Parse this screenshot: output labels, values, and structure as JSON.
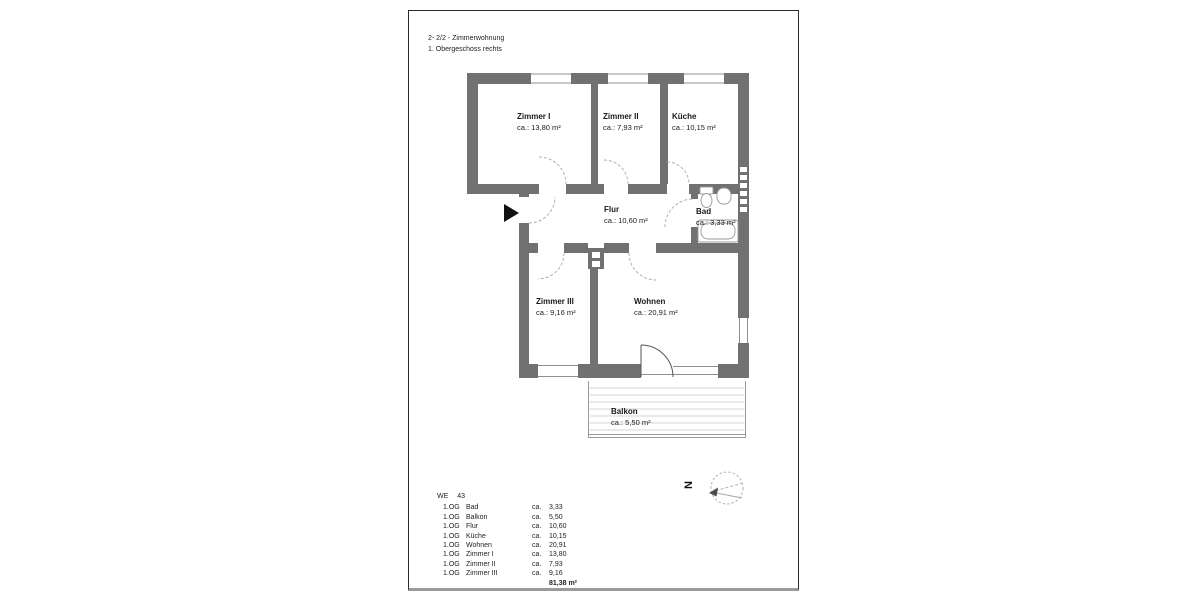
{
  "title": {
    "line1": "2- 2/2 - Zimmerwohnung",
    "line2": "1. Obergeschoss rechts"
  },
  "rooms": [
    {
      "name": "Zimmer I",
      "area": "ca.: 13,80 m²"
    },
    {
      "name": "Zimmer II",
      "area": "ca.: 7,93 m²"
    },
    {
      "name": "Küche",
      "area": "ca.: 10,15 m²"
    },
    {
      "name": "Flur",
      "area": "ca.: 10,60 m²"
    },
    {
      "name": "Bad",
      "area": "ca.: 3,33 m²"
    },
    {
      "name": "Zimmer III",
      "area": "ca.: 9,16 m²"
    },
    {
      "name": "Wohnen",
      "area": "ca.: 20,91 m²"
    },
    {
      "name": "Balkon",
      "area": "ca.: 5,50 m²"
    }
  ],
  "compass": {
    "north_label": "N"
  },
  "area_table": {
    "unit_label": "WE",
    "unit_number": "43",
    "rows": [
      {
        "floor": "1.OG",
        "room": "Bad",
        "prefix": "ca.",
        "value": "3,33"
      },
      {
        "floor": "1.OG",
        "room": "Balkon",
        "prefix": "ca.",
        "value": "5,50"
      },
      {
        "floor": "1.OG",
        "room": "Flur",
        "prefix": "ca.",
        "value": "10,60"
      },
      {
        "floor": "1.OG",
        "room": "Küche",
        "prefix": "ca.",
        "value": "10,15"
      },
      {
        "floor": "1.OG",
        "room": "Wohnen",
        "prefix": "ca.",
        "value": "20,91"
      },
      {
        "floor": "1.OG",
        "room": "Zimmer I",
        "prefix": "ca.",
        "value": "13,80"
      },
      {
        "floor": "1.OG",
        "room": "Zimmer II",
        "prefix": "ca.",
        "value": "7,93"
      },
      {
        "floor": "1.OG",
        "room": "Zimmer III",
        "prefix": "ca.",
        "value": "9,16"
      }
    ],
    "total": "81,38 m²"
  },
  "colors": {
    "wall_gray": "#717171",
    "line_gray": "#9a9a9a",
    "text": "#1f1f1f",
    "entrance_black": "#111111"
  }
}
